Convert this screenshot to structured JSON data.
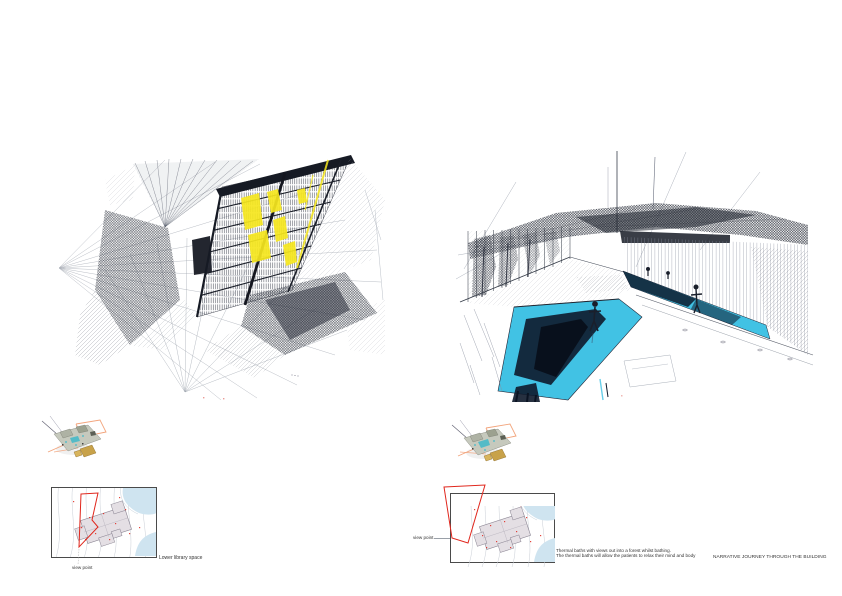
{
  "page": {
    "kind": "architectural presentation board",
    "width": 842,
    "height": 596,
    "background": "#ffffff"
  },
  "palette": {
    "ink": "#262b36",
    "ink_light": "#9aa0aa",
    "accent_yellow": "#f6e71e",
    "accent_cyan": "#41c2e4",
    "pool_navy": "#0e1a2b",
    "accent_red": "#e0261c",
    "accent_orange": "#f2a47c",
    "water_blue": "#cfe4f0",
    "plan_fill": "#e4dfe4",
    "plan_outline": "#8a8492",
    "contour_grey": "#c9ced6",
    "model_body": "#c6c9bd",
    "model_teal": "#3fb9c9",
    "model_tan": "#c8a24a",
    "label_color": "#333333"
  },
  "left_panel": {
    "figure_name": "lower-library-space-perspective-sketch",
    "view_point_label": "view point",
    "caption": "Lower library space"
  },
  "right_panel": {
    "figure_name": "thermal-baths-perspective-sketch",
    "view_point_label": "view point",
    "caption_line1": "Thermal baths with views out into a forest whilst bathing.",
    "caption_line2": "The thermal baths will allow the patients to relax their mind and body",
    "title": "NARRATIVE JOURNEY THROUGH THE BUILDING"
  }
}
